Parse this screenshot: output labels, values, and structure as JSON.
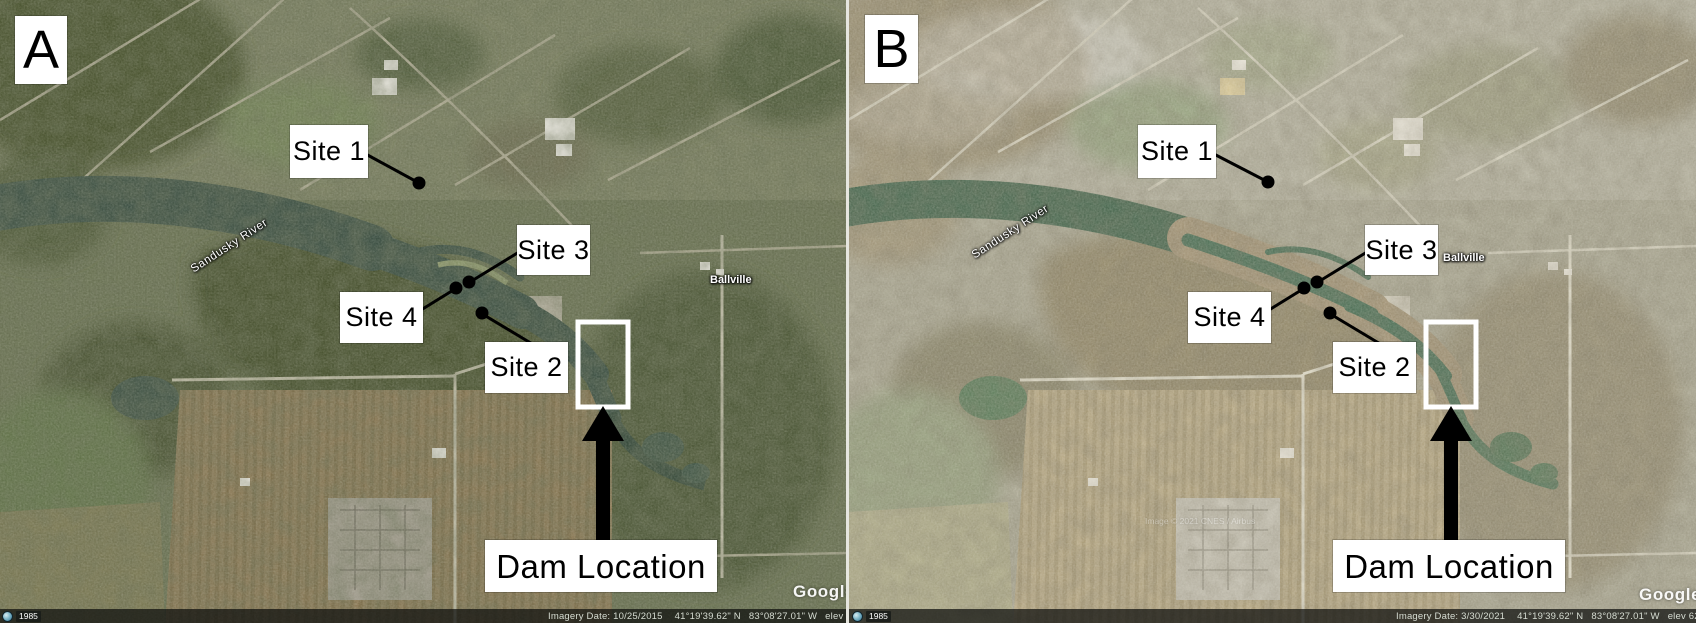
{
  "figure_type": "satellite_imagery_comparison",
  "colors": {
    "annotation_box_bg": "#ffffff",
    "annotation_text": "#000000",
    "leader_line": "#000000",
    "dam_outline_box": "#ffffff",
    "dam_arrow": "#000000",
    "panel_a_river": "#3d5145",
    "panel_b_river": "#50735a",
    "panel_b_exposed_sediment": "#a6977a",
    "status_bar_bg": "rgba(12,14,12,0.72)"
  },
  "panels": [
    {
      "label": "A",
      "sites": [
        {
          "label": "Site 1"
        },
        {
          "label": "Site 2"
        },
        {
          "label": "Site 3"
        },
        {
          "label": "Site 4"
        }
      ],
      "dam_label": "Dam Location",
      "map_labels": {
        "river": "Sandusky River",
        "town": "Ballville"
      },
      "status_bar": {
        "imagery_date": "Imagery Date: 10/25/2015",
        "latitude": "41°19'39.62\" N",
        "longitude": "83°08'27.01\" W",
        "elevation": "elev  626 ft",
        "eye_alt": "eye alt"
      },
      "google_watermark": "Google",
      "history_year": "1985"
    },
    {
      "label": "B",
      "sites": [
        {
          "label": "Site 1"
        },
        {
          "label": "Site 2"
        },
        {
          "label": "Site 3"
        },
        {
          "label": "Site 4"
        }
      ],
      "dam_label": "Dam Location",
      "map_labels": {
        "river": "Sandusky River",
        "town": "Ballville"
      },
      "status_bar": {
        "imagery_date": "Imagery Date: 3/30/2021",
        "latitude": "41°19'39.62\" N",
        "longitude": "83°08'27.01\" W",
        "elevation": "elev  626 ft",
        "eye_alt": "eye alt"
      },
      "google_watermark": "Google",
      "history_year": "1985",
      "center_watermark": "Image © 2021 CNES / Airbus"
    }
  ]
}
